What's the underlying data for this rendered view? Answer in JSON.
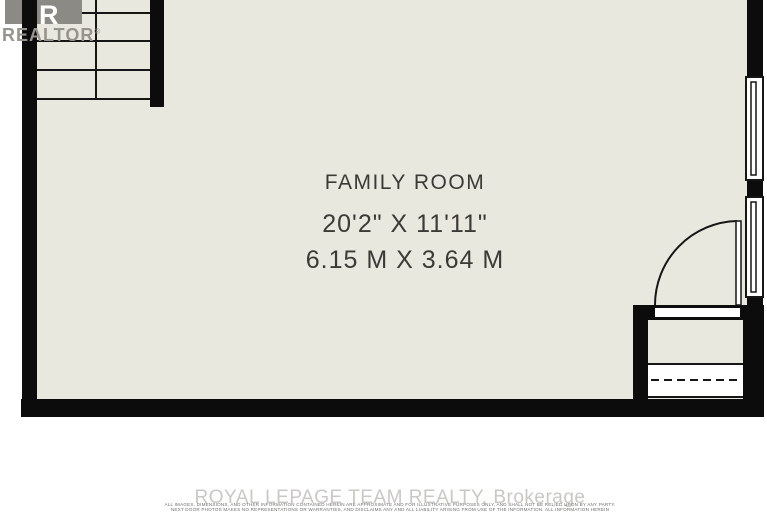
{
  "room": {
    "name": "FAMILY ROOM",
    "dimensions_imperial": "20'2\" X 11'11\"",
    "dimensions_metric": "6.15 M X 3.64 M"
  },
  "logo": {
    "r": "R",
    "text": "REALTOR",
    "registered": "®"
  },
  "footer": {
    "brokerage": "ROYAL LEPAGE TEAM REALTY, Brokerage",
    "disclaimer_line1": "ALL IMAGES, DIMENSIONS, AND OTHER INFORMATION CONTAINED HEREIN ARE APPROXIMATE AND FOR ILLUSTRATIVE PURPOSES ONLY, AND SHALL NOT BE RELIED UPON BY ANY PARTY.",
    "disclaimer_line2": "NEXT DOOR PHOTOS MAKES NO REPRESENTATIONS OR WARRANTIES, AND DISCLAIMS ANY AND ALL LIABILITY ARISING FROM USE OF THE INFORMATION. ALL INFORMATION HEREIN"
  },
  "colors": {
    "floor": "#e9e8df",
    "wall": "#0c0c0c",
    "line": "#161616",
    "label_text": "#3b3a36",
    "logo_gray": "#8b8a84",
    "watermark_gray": "#c9c8c5"
  }
}
